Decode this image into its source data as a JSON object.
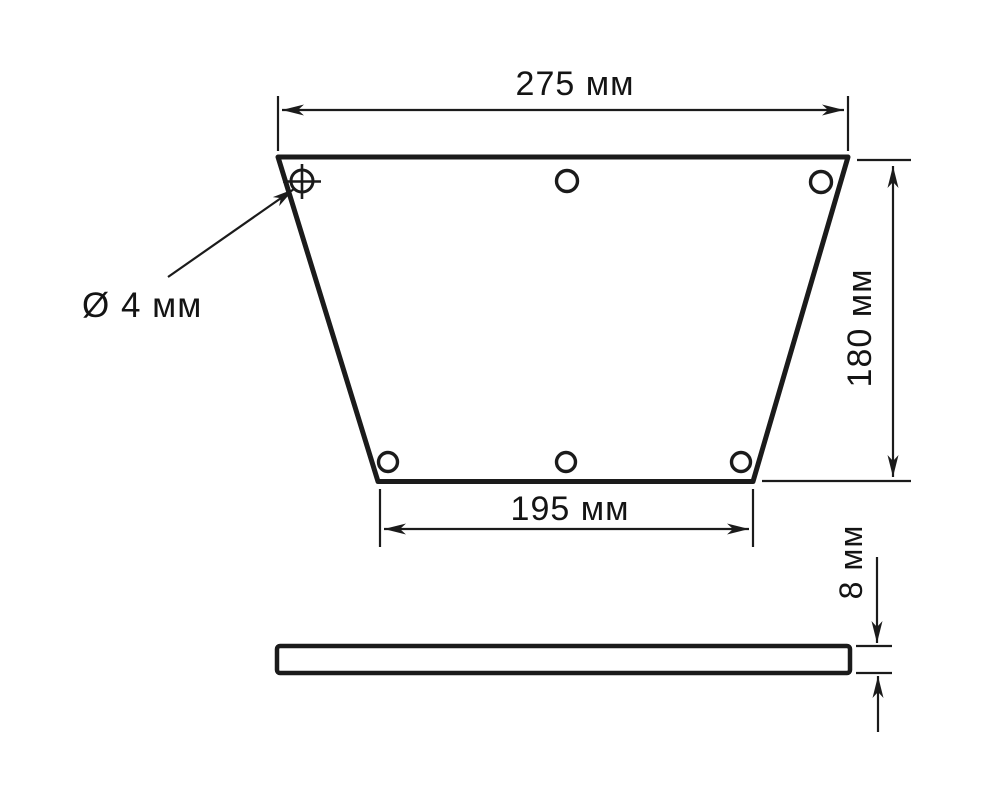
{
  "drawing": {
    "background_color": "#ffffff",
    "line_color": "#1b1b1b",
    "front_view": {
      "top_width_label": "275 мм",
      "height_label": "180 мм",
      "bottom_width_label": "195 мм",
      "hole_diameter_label": "Ø 4 мм",
      "hole_count": 6
    },
    "side_view": {
      "thickness_label": "8 мм"
    }
  }
}
